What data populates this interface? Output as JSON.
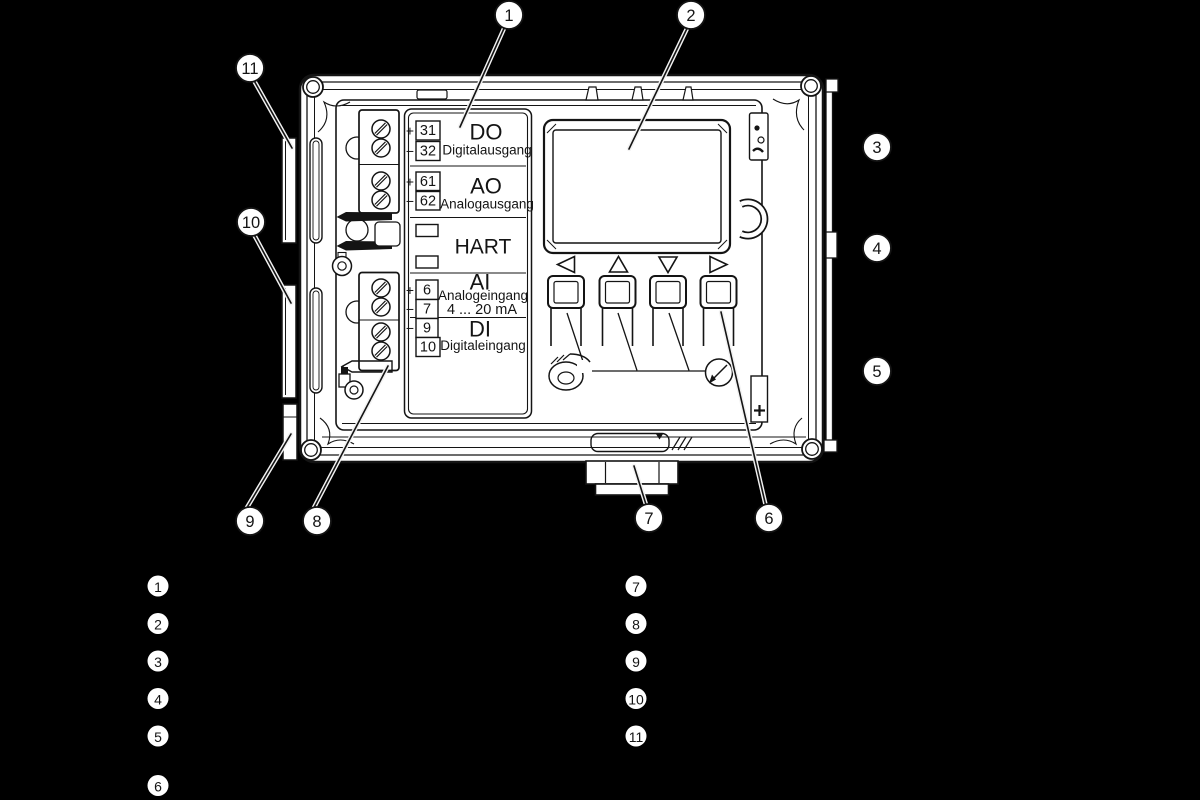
{
  "figure": {
    "type": "technical-illustration",
    "subject": "field device housing, open, with display, keypad and terminal label",
    "colors": {
      "background": "#000000",
      "line_art": "#141414",
      "fill": "#ffffff"
    },
    "label_panel": {
      "rows": {
        "do": {
          "code": "DO",
          "name": "Digitalausgang",
          "t1_sign": "+",
          "t1": "31",
          "t2_sign": "−",
          "t2": "32"
        },
        "ao": {
          "code": "AO",
          "name": "Analogausgang",
          "t1_sign": "+",
          "t1": "61",
          "t2_sign": "−",
          "t2": "62"
        },
        "hart": {
          "code": "HART"
        },
        "ai": {
          "code": "AI",
          "name": "Analogeingang",
          "range": "4 ... 20 mA",
          "t1_sign": "+",
          "t1": "6",
          "t2_sign": "−",
          "t2": "7"
        },
        "di": {
          "code": "DI",
          "name": "Digitaleingang",
          "t1_sign": "−",
          "t1": "9",
          "t2": "10"
        }
      }
    },
    "callouts": {
      "c1": "1",
      "c2": "2",
      "c3": "3",
      "c4": "4",
      "c5": "5",
      "c6": "6",
      "c7": "7",
      "c8": "8",
      "c9": "9",
      "c10": "10",
      "c11": "11"
    },
    "legend": {
      "left": [
        "1",
        "2",
        "3",
        "4",
        "5",
        "6"
      ],
      "right": [
        "7",
        "8",
        "9",
        "10",
        "11"
      ]
    }
  }
}
